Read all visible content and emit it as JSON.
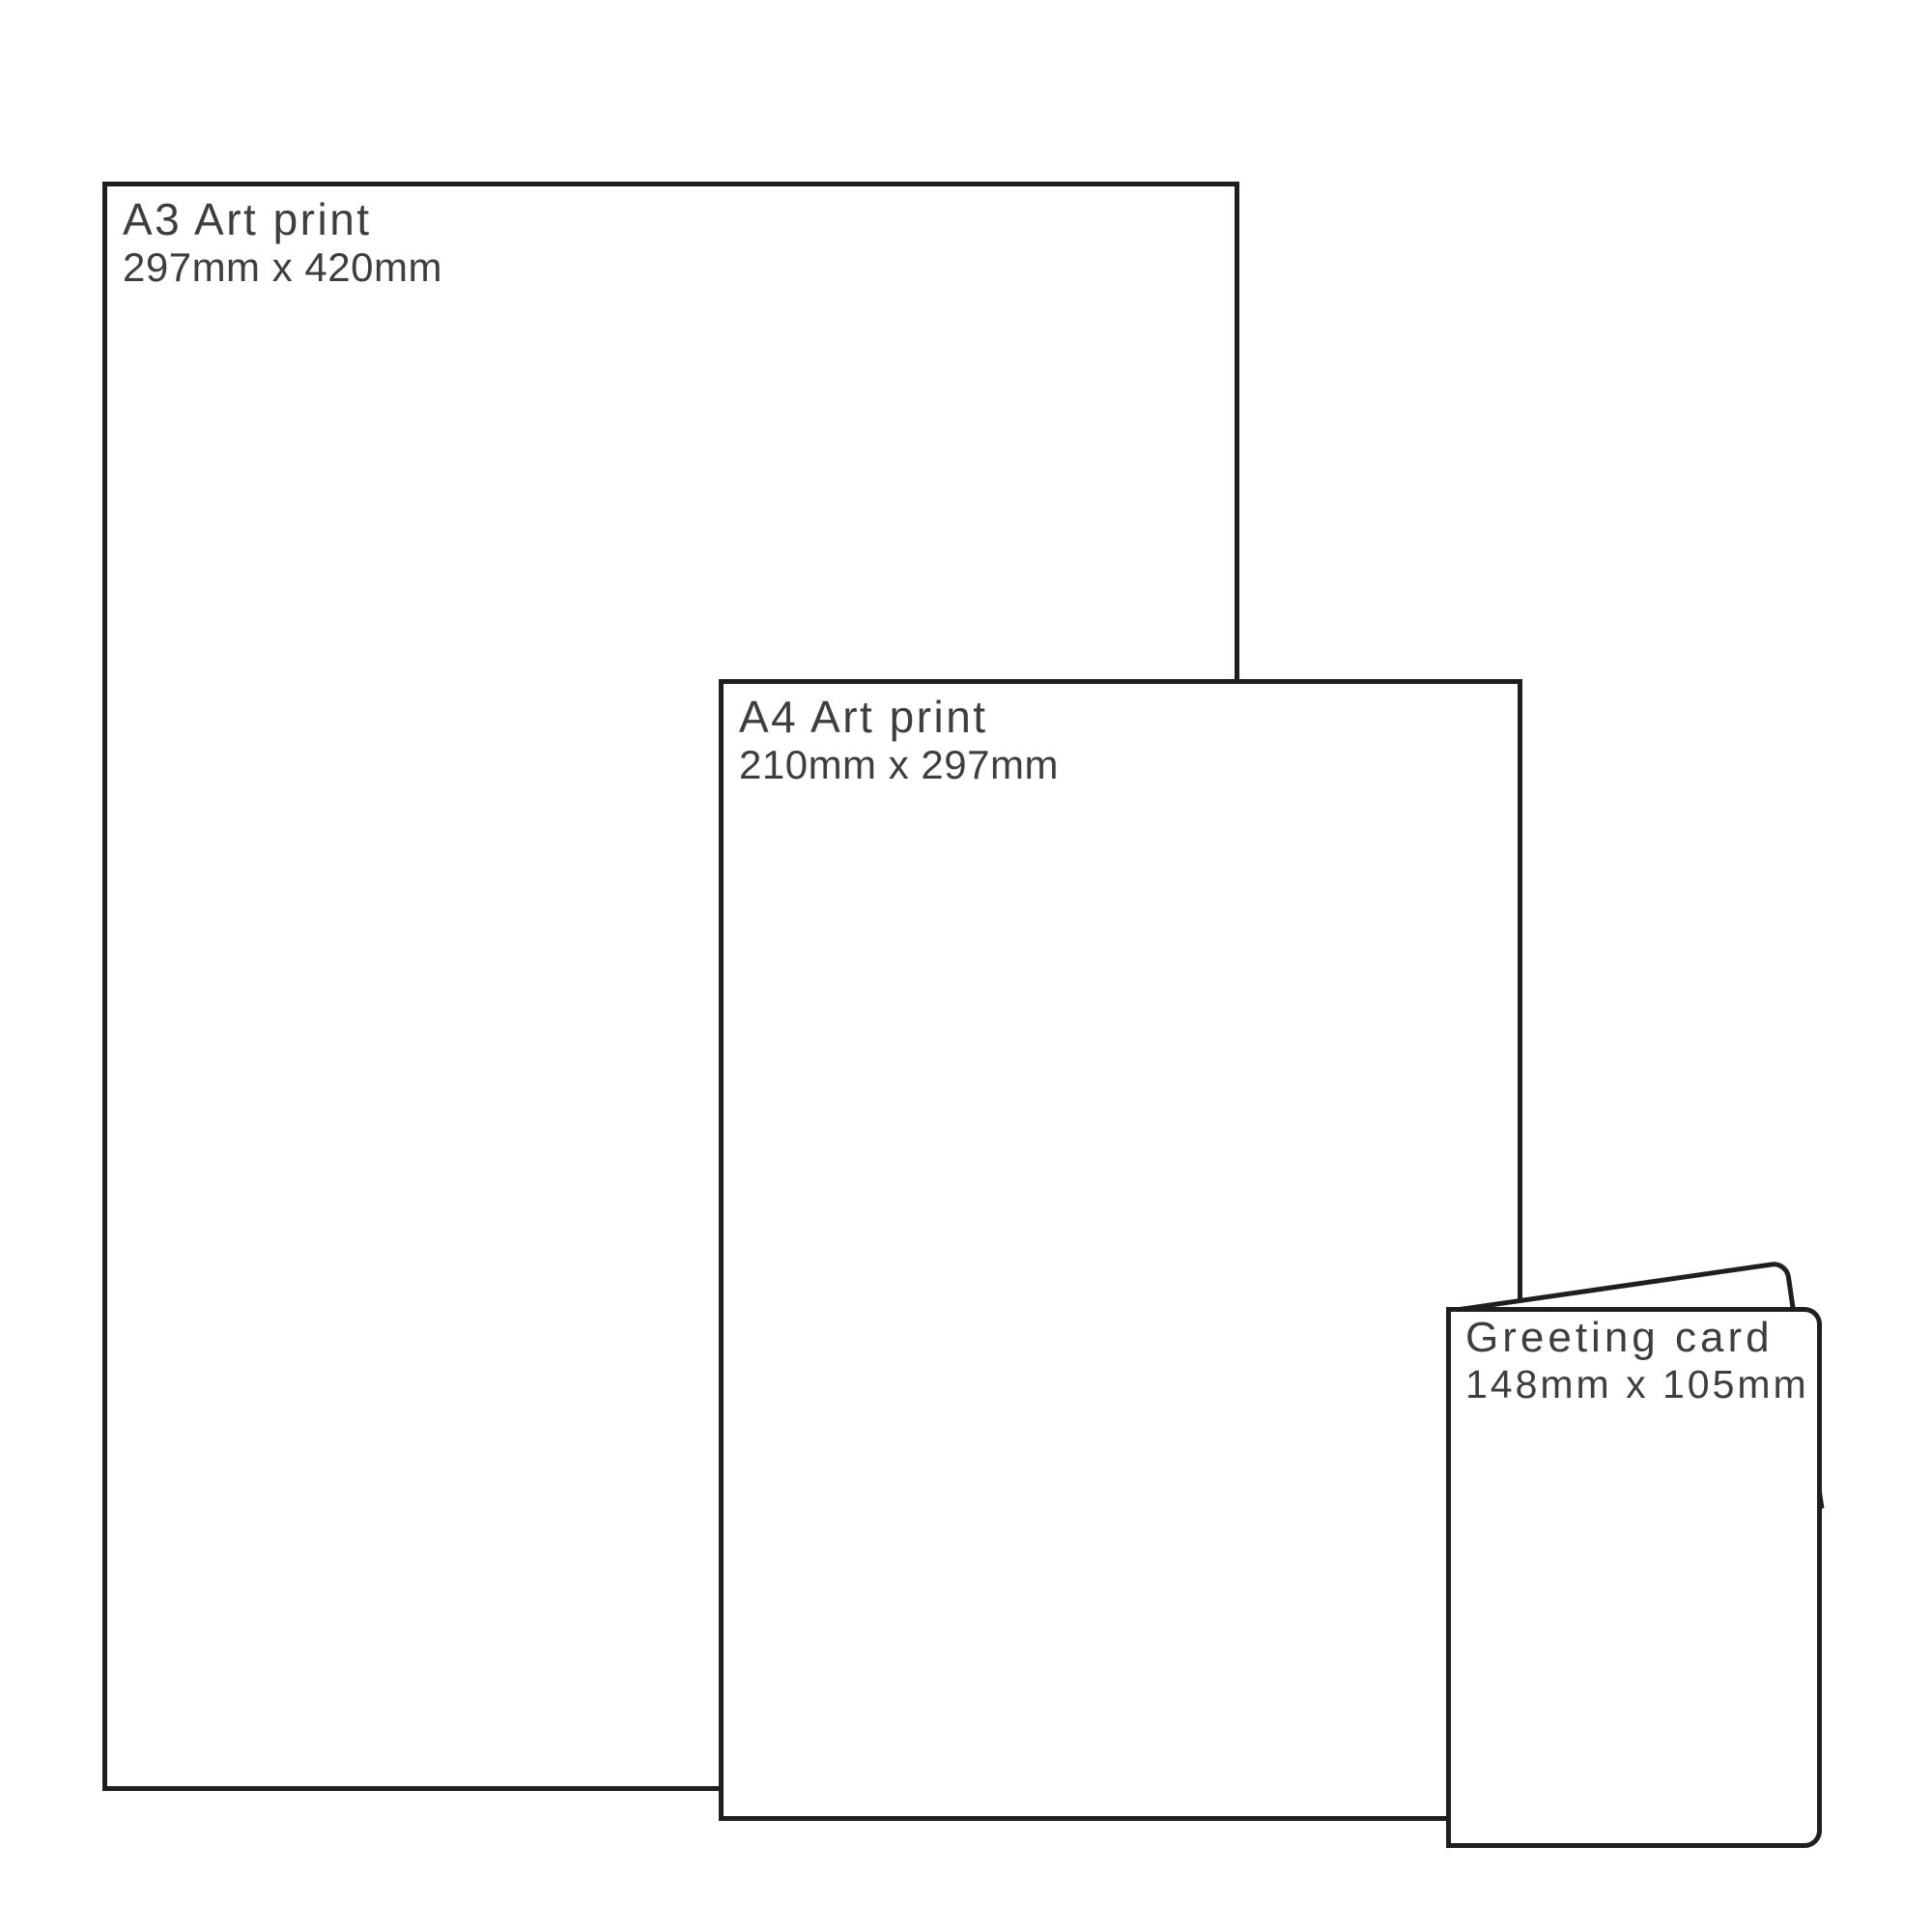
{
  "figure": {
    "background_color": "#ffffff",
    "outline_color": "#1f1f1f",
    "text_color": "#3e3e3e"
  },
  "products": [
    {
      "title": "A3 Art print",
      "dimensions": "297mm x 420mm"
    },
    {
      "title": "A4 Art print",
      "dimensions": "210mm x 297mm"
    },
    {
      "title": "Greeting card",
      "dimensions": "148mm x 105mm"
    }
  ]
}
